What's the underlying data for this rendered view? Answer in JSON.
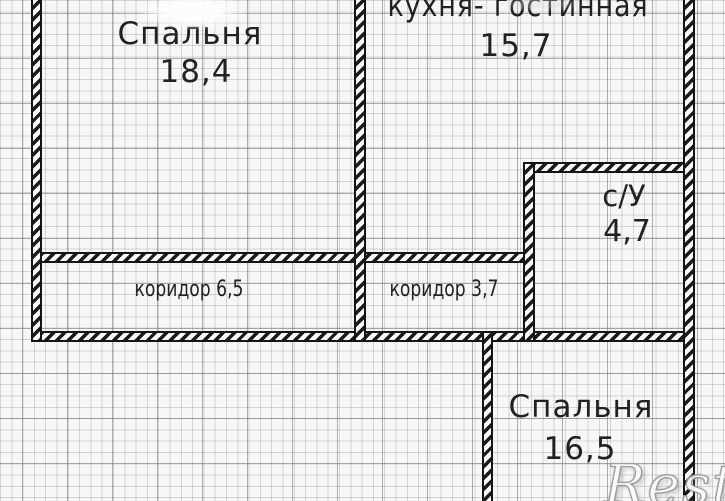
{
  "plan": {
    "rooms": [
      {
        "id": "bedroom-top",
        "label": "Спальня",
        "area": "18,4"
      },
      {
        "id": "kitchen-living",
        "label": "кухня- гостинная",
        "area": "15,7"
      },
      {
        "id": "bathroom",
        "label": "с/У",
        "area": "4,7"
      },
      {
        "id": "corridor-left",
        "label": "коридор",
        "area": "6,5"
      },
      {
        "id": "corridor-right",
        "label": "коридор",
        "area": "3,7"
      },
      {
        "id": "bedroom-bottom",
        "label": "Спальня",
        "area": "16,5"
      }
    ],
    "watermark": "Restate",
    "colors": {
      "paper": "#f7f7f5",
      "wall": "#141414",
      "grid_minor": "#cfcfcf",
      "grid_major": "#a8a8a8",
      "text": "#212121"
    }
  }
}
